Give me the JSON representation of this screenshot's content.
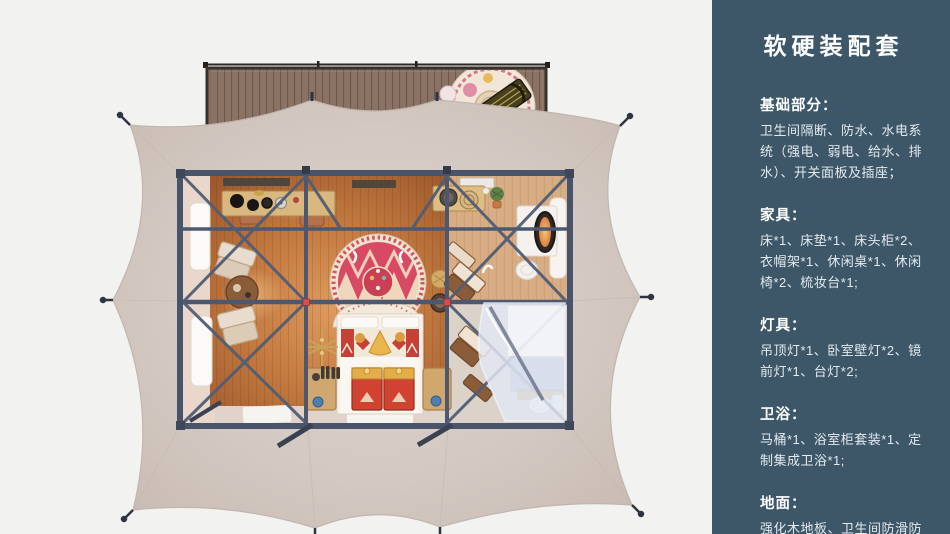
{
  "page": {
    "bg_color": "#f2f2f1"
  },
  "sidebar": {
    "bg_color": "#3d5769",
    "text_color": "#ffffff",
    "title": "软硬装配套",
    "sections": [
      {
        "heading": "基础部分：",
        "body": "卫生间隔断、防水、水电系统（强电、弱电、给水、排水）、开关面板及插座；"
      },
      {
        "heading": "家具：",
        "body": "床*1、床垫*1、床头柜*2、衣帽架*1、休闲桌*1、休闲椅*2、梳妆台*1;"
      },
      {
        "heading": "灯具：",
        "body": "吊顶灯*1、卧室壁灯*2、镜前灯*1、台灯*2;"
      },
      {
        "heading": "卫浴：",
        "body": "马桶*1、浴室柜套装*1、定制集成卫浴*1;"
      },
      {
        "heading": "地面：",
        "body": "强化木地板、卫生间防滑防潮石塑板;"
      }
    ]
  },
  "floorplan": {
    "view": "top-down render of glamping tent suite with front deck",
    "colors": {
      "canopy": "#d5cac3",
      "frame": "#4b556a",
      "floor_wood": "#c07a45",
      "deck_wood": "#8a7365",
      "rug_red": "#d84a63",
      "bed_white": "#f7f2ec",
      "chest_red": "#d04331",
      "glass": "#e3e9f4",
      "connector_red": "#d4504a"
    }
  }
}
